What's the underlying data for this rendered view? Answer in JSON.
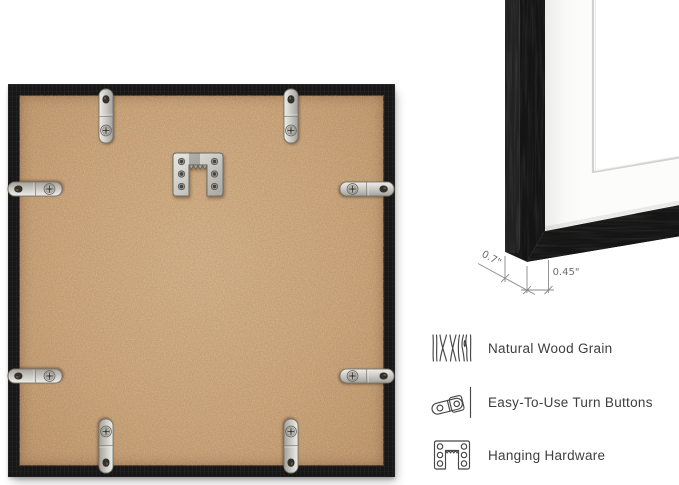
{
  "colors": {
    "frame_black": "#171717",
    "mdf_backing": "#c9a378",
    "metal_hardware": "#cfcdc7",
    "mat_white": "#fbfbfa",
    "feature_text": "#3e3e3e",
    "dimension_lines": "#8a8a8a"
  },
  "back_view": {
    "turn_buttons": 8,
    "hanger": "sawtooth-hanger-icon"
  },
  "closeup": {
    "depth_label": "0.7\"",
    "width_label": "0.45\""
  },
  "features": [
    {
      "icon": "wood-grain-icon",
      "label": "Natural Wood Grain"
    },
    {
      "icon": "turn-button-icon",
      "label": "Easy-To-Use Turn Buttons"
    },
    {
      "icon": "hanging-hardware-icon",
      "label": "Hanging Hardware"
    }
  ]
}
